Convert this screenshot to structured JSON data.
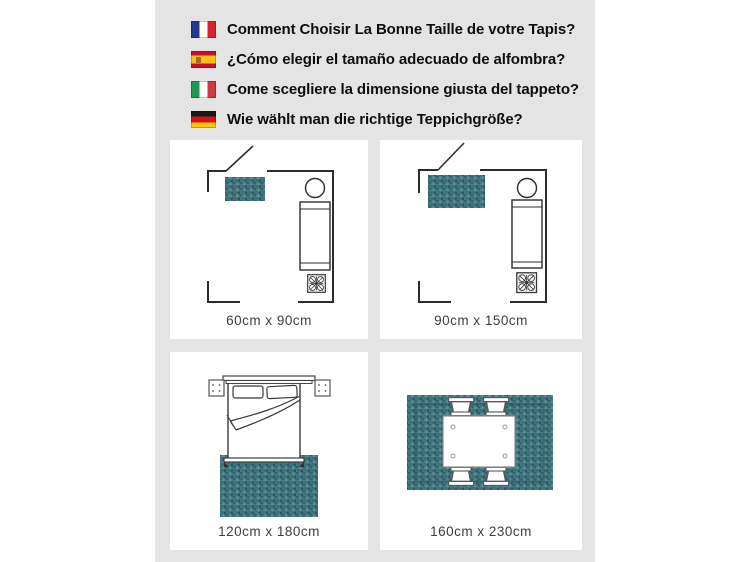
{
  "page": {
    "background": "#ffffff",
    "band_background": "#e4e4e4",
    "card_background": "#ffffff"
  },
  "colors": {
    "rug_teal": "#447680",
    "rug_teal_dark": "#2c5662",
    "wall_line": "#2c2c2c",
    "header_text": "#0e0e0e",
    "label_text": "#3d3d3d"
  },
  "header": {
    "items": [
      {
        "flag_icon": "flag-france-icon",
        "label": "Comment Choisir La Bonne Taille de votre Tapis?"
      },
      {
        "flag_icon": "flag-spain-icon",
        "label": "¿Cómo elegir el tamaño adecuado de alfombra?"
      },
      {
        "flag_icon": "flag-italy-icon",
        "label": "Come scegliere la dimensione giusta del tappeto?"
      },
      {
        "flag_icon": "flag-germany-icon",
        "label": "Wie wählt man die richtige Teppichgröße?"
      }
    ]
  },
  "panels": [
    {
      "scene": "room-floorplan-small-rug",
      "label": "60cm x 90cm"
    },
    {
      "scene": "room-floorplan-medium-rug",
      "label": "90cm x 150cm"
    },
    {
      "scene": "bedroom-rug-under-bed",
      "label": "120cm x 180cm"
    },
    {
      "scene": "dining-table-on-rug",
      "label": "160cm x 230cm"
    }
  ]
}
